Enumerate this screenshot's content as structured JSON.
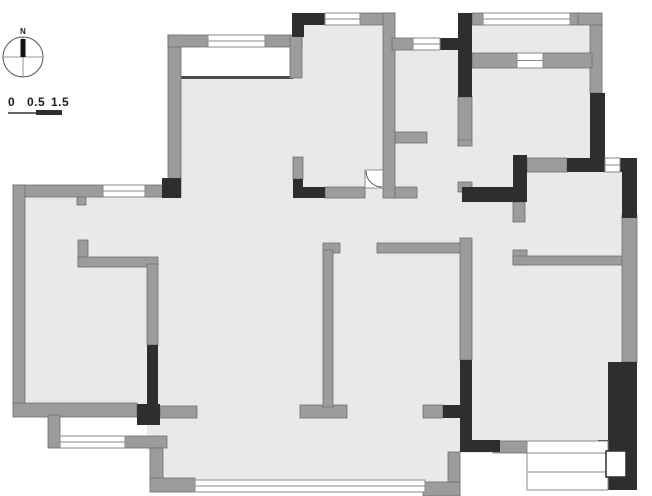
{
  "meta": {
    "title": "apartment-floor-plan"
  },
  "compass": {
    "label": "N",
    "icon_name": "north-arrow-icon"
  },
  "scale_bar": {
    "labels": [
      "0",
      "0.5",
      "1.5"
    ]
  },
  "colors": {
    "background": "#ffffff",
    "room_fill": "#e9e9e9",
    "wall_gray": "#9c9c9c",
    "wall_gray_stroke": "#6f6f6f",
    "wall_dark": "#2e2e2e",
    "window_fill": "#ffffff",
    "window_stroke": "#8a8a8a",
    "thin_line": "#4a4a4a",
    "compass_stroke": "#555555",
    "needle_fill": "#111111"
  },
  "plan": {
    "canvas": {
      "width": 652,
      "height": 496
    },
    "fills": [
      [
        181,
        77,
        279,
        406
      ],
      [
        25,
        197,
        156,
        210
      ],
      [
        302,
        25,
        81,
        55
      ],
      [
        395,
        50,
        77,
        195
      ],
      [
        472,
        25,
        120,
        147
      ],
      [
        472,
        145,
        55,
        120
      ],
      [
        513,
        172,
        124,
        93
      ],
      [
        460,
        253,
        165,
        200
      ],
      [
        158,
        267,
        26,
        215
      ],
      [
        147,
        425,
        16,
        25
      ]
    ],
    "gray_walls": [
      [
        168,
        35,
        13,
        162
      ],
      [
        168,
        35,
        40,
        12
      ],
      [
        265,
        35,
        37,
        12
      ],
      [
        290,
        35,
        12,
        43
      ],
      [
        360,
        13,
        35,
        12
      ],
      [
        383,
        13,
        12,
        185
      ],
      [
        395,
        132,
        32,
        11
      ],
      [
        395,
        187,
        22,
        11
      ],
      [
        293,
        157,
        10,
        22
      ],
      [
        325,
        187,
        40,
        11
      ],
      [
        392,
        38,
        21,
        12
      ],
      [
        458,
        97,
        14,
        48
      ],
      [
        472,
        13,
        11,
        12
      ],
      [
        570,
        13,
        12,
        12
      ],
      [
        578,
        13,
        24,
        12
      ],
      [
        590,
        25,
        12,
        68
      ],
      [
        472,
        53,
        45,
        15
      ],
      [
        543,
        53,
        49,
        15
      ],
      [
        527,
        158,
        40,
        14
      ],
      [
        458,
        140,
        14,
        6
      ],
      [
        458,
        182,
        14,
        10
      ],
      [
        513,
        202,
        12,
        20
      ],
      [
        513,
        250,
        14,
        15
      ],
      [
        513,
        256,
        117,
        9
      ],
      [
        622,
        215,
        15,
        147
      ],
      [
        377,
        243,
        85,
        10
      ],
      [
        460,
        238,
        12,
        122
      ],
      [
        423,
        405,
        20,
        13
      ],
      [
        493,
        441,
        34,
        12
      ],
      [
        448,
        452,
        12,
        44
      ],
      [
        423,
        482,
        37,
        14
      ],
      [
        13,
        185,
        90,
        12
      ],
      [
        145,
        185,
        18,
        12
      ],
      [
        77,
        197,
        9,
        8
      ],
      [
        13,
        185,
        12,
        225
      ],
      [
        13,
        403,
        124,
        14
      ],
      [
        160,
        406,
        37,
        12
      ],
      [
        48,
        415,
        12,
        33
      ],
      [
        125,
        436,
        42,
        12
      ],
      [
        150,
        448,
        13,
        34
      ],
      [
        150,
        478,
        45,
        14
      ],
      [
        78,
        240,
        10,
        27
      ],
      [
        78,
        257,
        80,
        10
      ],
      [
        147,
        264,
        11,
        81
      ],
      [
        300,
        405,
        47,
        13
      ],
      [
        323,
        243,
        17,
        10
      ],
      [
        323,
        250,
        10,
        157
      ]
    ],
    "dark_walls": [
      [
        162,
        178,
        19,
        20
      ],
      [
        292,
        13,
        33,
        12
      ],
      [
        292,
        25,
        12,
        12
      ],
      [
        293,
        179,
        10,
        19
      ],
      [
        293,
        187,
        32,
        11
      ],
      [
        440,
        38,
        20,
        12
      ],
      [
        458,
        13,
        14,
        84
      ],
      [
        590,
        93,
        15,
        67
      ],
      [
        513,
        155,
        14,
        47
      ],
      [
        567,
        158,
        38,
        14
      ],
      [
        620,
        158,
        17,
        14
      ],
      [
        462,
        187,
        51,
        15
      ],
      [
        622,
        160,
        15,
        58
      ],
      [
        608,
        362,
        29,
        128
      ],
      [
        460,
        360,
        12,
        92
      ],
      [
        443,
        405,
        17,
        13
      ],
      [
        460,
        440,
        40,
        12
      ],
      [
        137,
        404,
        23,
        21
      ],
      [
        147,
        345,
        11,
        60
      ],
      [
        598,
        440,
        39,
        50
      ]
    ],
    "windows": [
      [
        208,
        35,
        57,
        12
      ],
      [
        325,
        13,
        35,
        12
      ],
      [
        413,
        38,
        27,
        12
      ],
      [
        483,
        13,
        87,
        12
      ],
      [
        605,
        158,
        15,
        14
      ],
      [
        103,
        185,
        42,
        12
      ],
      [
        60,
        436,
        65,
        12
      ],
      [
        195,
        480,
        230,
        12
      ],
      [
        517,
        53,
        26,
        15
      ]
    ],
    "thin_lines": [
      [
        181,
        76,
        112,
        3
      ],
      [
        472,
        66,
        120,
        2
      ]
    ],
    "bay_window": {
      "rect": [
        527,
        441,
        81,
        49
      ],
      "inner_lines_y": [
        453,
        472
      ]
    },
    "utility_box": {
      "rect": [
        606,
        451,
        20,
        26
      ]
    },
    "entry_door": {
      "rect": [
        365,
        170,
        18,
        18
      ]
    },
    "compass": {
      "cx": 23,
      "cy": 57,
      "r": 20,
      "needle": [
        20.5,
        39,
        5,
        18
      ]
    },
    "scale_graphic": {
      "thin_line": [
        8,
        113,
        36,
        113
      ],
      "thick_bar": [
        36,
        110,
        26,
        5
      ]
    }
  }
}
